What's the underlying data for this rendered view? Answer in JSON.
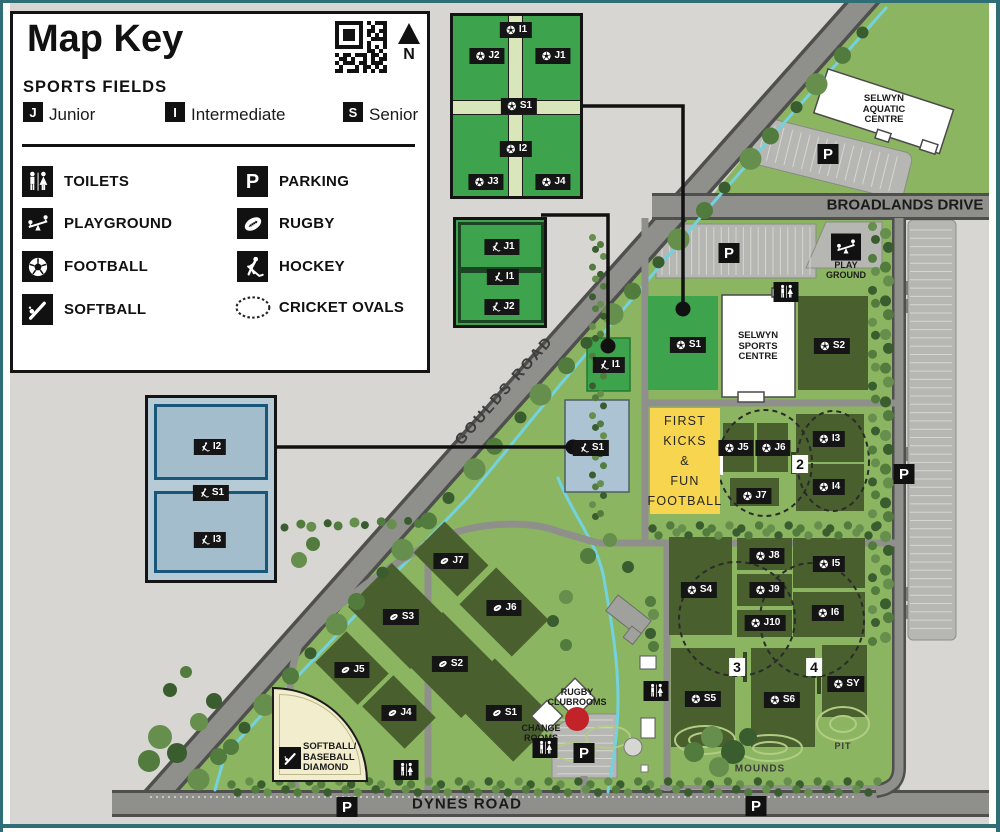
{
  "map_key": {
    "title": "Map Key",
    "sports_fields_heading": "SPORTS FIELDS",
    "north_label": "N",
    "qr_icon": "qr-code",
    "levels": [
      {
        "code": "J",
        "label": "Junior"
      },
      {
        "code": "I",
        "label": "Intermediate"
      },
      {
        "code": "S",
        "label": "Senior"
      }
    ],
    "legend": [
      {
        "icon": "toilets-icon",
        "label": "TOILETS"
      },
      {
        "icon": "parking-icon",
        "label": "PARKING"
      },
      {
        "icon": "playground-icon",
        "label": "PLAYGROUND"
      },
      {
        "icon": "rugby-icon",
        "label": "RUGBY"
      },
      {
        "icon": "football-icon",
        "label": "FOOTBALL"
      },
      {
        "icon": "hockey-icon",
        "label": "HOCKEY"
      },
      {
        "icon": "softball-icon",
        "label": "SOFTBALL"
      },
      {
        "icon": "cricket-ovals-icon",
        "label": "CRICKET OVALS"
      }
    ]
  },
  "roads": {
    "goulds": "GOULDS ROAD",
    "broadlands": "BROADLANDS DRIVE",
    "dynes": "DYNES ROAD"
  },
  "places": {
    "aquatic_centre": [
      "SELWYN",
      "AQUATIC",
      "CENTRE"
    ],
    "sports_centre": [
      "SELWYN",
      "SPORTS",
      "CENTRE"
    ],
    "rugby_clubrooms": [
      "RUGBY",
      "CLUBROOMS"
    ],
    "change_rooms": [
      "CHANGE",
      "ROOMS"
    ],
    "playground": [
      "PLAY",
      "GROUND"
    ],
    "first_kicks": [
      "FIRST",
      "KICKS",
      "&",
      "FUN",
      "FOOTBALL"
    ],
    "softball_diamond": [
      "SOFTBALL/",
      "BASEBALL",
      "DIAMOND"
    ],
    "mounds": "MOUNDS",
    "pit": "PIT"
  },
  "map_markers": {
    "fields": [
      {
        "sport": "football",
        "label": "I1",
        "x": 516,
        "y": 30
      },
      {
        "sport": "football",
        "label": "J2",
        "x": 487,
        "y": 56
      },
      {
        "sport": "football",
        "label": "J1",
        "x": 553,
        "y": 56
      },
      {
        "sport": "football",
        "label": "S1",
        "x": 519,
        "y": 106
      },
      {
        "sport": "football",
        "label": "I2",
        "x": 516,
        "y": 149
      },
      {
        "sport": "football",
        "label": "J3",
        "x": 486,
        "y": 182
      },
      {
        "sport": "football",
        "label": "J4",
        "x": 553,
        "y": 182
      },
      {
        "sport": "hockey",
        "label": "J1",
        "x": 502,
        "y": 247
      },
      {
        "sport": "hockey",
        "label": "I1",
        "x": 503,
        "y": 277
      },
      {
        "sport": "hockey",
        "label": "J2",
        "x": 502,
        "y": 307
      },
      {
        "sport": "hockey",
        "label": "I2",
        "x": 210,
        "y": 447
      },
      {
        "sport": "hockey",
        "label": "S1",
        "x": 211,
        "y": 493
      },
      {
        "sport": "hockey",
        "label": "I3",
        "x": 210,
        "y": 540
      },
      {
        "sport": "football",
        "label": "S1",
        "x": 688,
        "y": 345
      },
      {
        "sport": "football",
        "label": "S2",
        "x": 832,
        "y": 346
      },
      {
        "sport": "football",
        "label": "J5",
        "x": 736,
        "y": 448
      },
      {
        "sport": "football",
        "label": "J6",
        "x": 773,
        "y": 448
      },
      {
        "sport": "football",
        "label": "I3",
        "x": 829,
        "y": 439
      },
      {
        "sport": "football",
        "label": "I4",
        "x": 829,
        "y": 487
      },
      {
        "sport": "football",
        "label": "J7",
        "x": 754,
        "y": 496
      },
      {
        "sport": "football",
        "label": "S4",
        "x": 699,
        "y": 590
      },
      {
        "sport": "football",
        "label": "J8",
        "x": 767,
        "y": 556
      },
      {
        "sport": "football",
        "label": "J9",
        "x": 767,
        "y": 590
      },
      {
        "sport": "football",
        "label": "J10",
        "x": 765,
        "y": 623
      },
      {
        "sport": "football",
        "label": "I5",
        "x": 829,
        "y": 564
      },
      {
        "sport": "football",
        "label": "I6",
        "x": 828,
        "y": 613
      },
      {
        "sport": "football",
        "label": "S5",
        "x": 703,
        "y": 699
      },
      {
        "sport": "football",
        "label": "S6",
        "x": 782,
        "y": 700
      },
      {
        "sport": "football",
        "label": "SY",
        "x": 846,
        "y": 684
      },
      {
        "sport": "rugby",
        "label": "J7",
        "x": 451,
        "y": 561
      },
      {
        "sport": "rugby",
        "label": "S3",
        "x": 401,
        "y": 617
      },
      {
        "sport": "rugby",
        "label": "J6",
        "x": 504,
        "y": 608
      },
      {
        "sport": "rugby",
        "label": "S2",
        "x": 450,
        "y": 664
      },
      {
        "sport": "rugby",
        "label": "J5",
        "x": 352,
        "y": 670
      },
      {
        "sport": "rugby",
        "label": "J4",
        "x": 399,
        "y": 713
      },
      {
        "sport": "rugby",
        "label": "S1",
        "x": 504,
        "y": 713
      },
      {
        "sport": "hockey",
        "label": "I1",
        "x": 609,
        "y": 365
      },
      {
        "sport": "hockey",
        "label": "S1",
        "x": 591,
        "y": 448
      }
    ],
    "numbers": [
      {
        "label": "2",
        "x": 800,
        "y": 464
      },
      {
        "label": "3",
        "x": 737,
        "y": 667
      },
      {
        "label": "4",
        "x": 814,
        "y": 667
      }
    ],
    "parking": [
      {
        "x": 729,
        "y": 253
      },
      {
        "x": 828,
        "y": 154
      },
      {
        "x": 904,
        "y": 474
      },
      {
        "x": 347,
        "y": 807
      },
      {
        "x": 756,
        "y": 806
      },
      {
        "x": 584,
        "y": 753
      }
    ],
    "toilets": [
      {
        "x": 786,
        "y": 292
      },
      {
        "x": 656,
        "y": 691
      },
      {
        "x": 545,
        "y": 748
      },
      {
        "x": 406,
        "y": 770
      }
    ],
    "playground": [
      {
        "x": 846,
        "y": 247
      }
    ],
    "softball": [
      {
        "x": 290,
        "y": 758
      }
    ],
    "connector_dots": [
      {
        "x": 683,
        "y": 309
      },
      {
        "x": 608,
        "y": 346
      },
      {
        "x": 573,
        "y": 447
      }
    ]
  },
  "colors": {
    "park_green": "#8cb561",
    "bright_field_green": "#3da34c",
    "dark_field_green": "#49602e",
    "road_grey": "#8f8f8c",
    "outside_grey": "#d7d6d2",
    "parking_grey": "#b6b6b3",
    "water_blue": "#74d2de",
    "hockey_turf_blue": "#a3bdcd",
    "first_kicks_yellow": "#f7d54e",
    "softball_cream": "#f2eecd",
    "label_black": "#151515",
    "clubrooms_red": "#c22328",
    "frame_teal": "#2f6e75"
  }
}
